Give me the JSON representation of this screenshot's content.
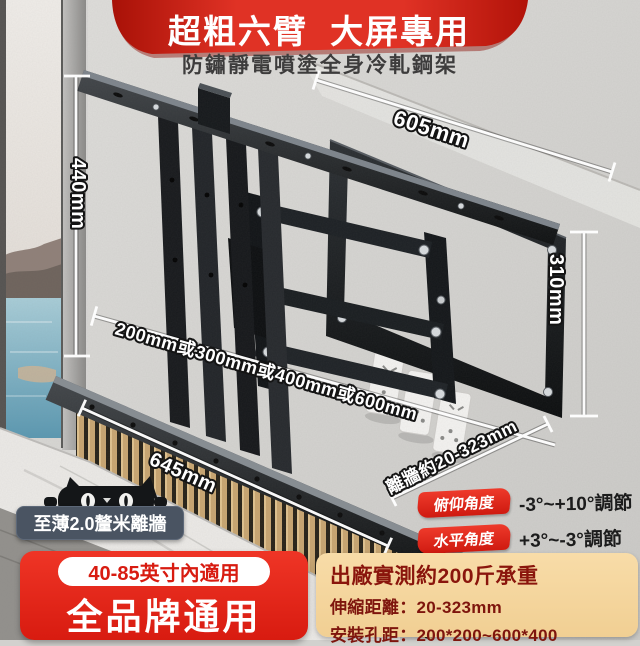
{
  "banner": {
    "title": "超粗六臂  大屏專用",
    "subtitle": "防鏽靜電噴塗全身冷軋鋼架"
  },
  "dimensions": {
    "top_width": "605mm",
    "left_height": "440mm",
    "right_height": "310mm",
    "bottom_width": "645mm",
    "hole_options": "200mm或300mm或400mm或600mm",
    "wall_distance": "離牆約20-323mm"
  },
  "angles": [
    {
      "label": "俯仰角度",
      "value": "-3°~+10°調節"
    },
    {
      "label": "水平角度",
      "value": "+3°~-3°調節"
    }
  ],
  "badges": {
    "thickness": "至薄2.0釐米離牆",
    "size_range": "40-85英寸內適用",
    "universal": "全品牌通用"
  },
  "specs": {
    "load": "出廠實測約200斤承重",
    "extension": "伸縮距離：20-323mm",
    "hole_pitch": "安裝孔距：200*200~600*400"
  },
  "colors": {
    "banner_red": "#d8251a",
    "accent_red": "#d81b10",
    "badge_slate": "#4a5462",
    "spec_tan": "#f5d7a2",
    "spec_text": "#7e150d",
    "bracket_black": "#141618"
  }
}
